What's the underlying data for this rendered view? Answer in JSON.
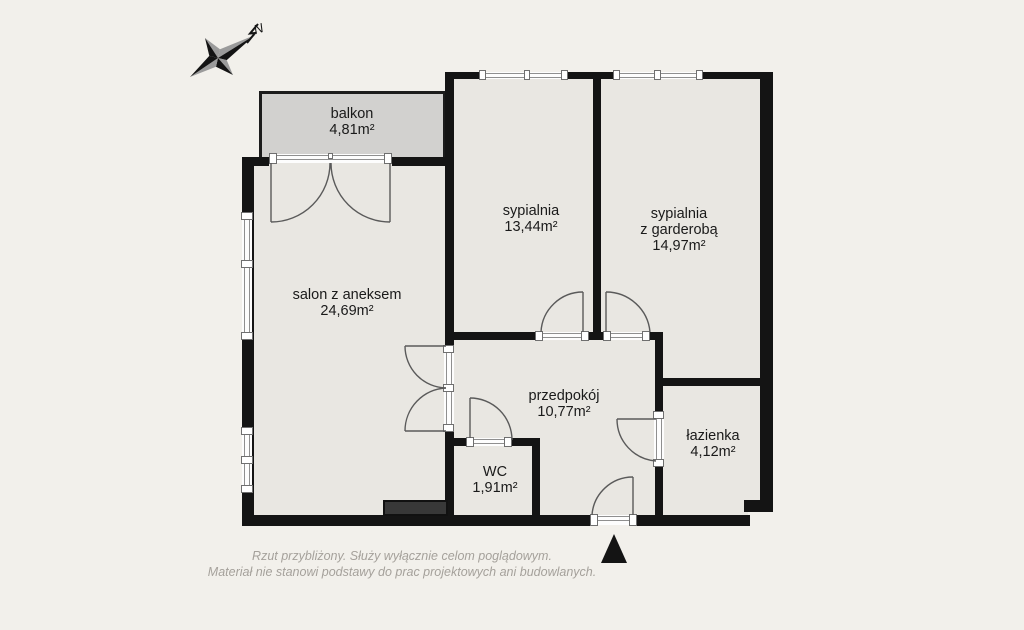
{
  "meta": {
    "background": "#f2f0eb",
    "room_fill": "#e9e7e2",
    "wall_color": "#141414",
    "balcony_fill": "#d2d1cf",
    "dark_block_color": "#383838",
    "door_line_color": "#5a5a5a",
    "label_color": "#1a1a1a",
    "footer_color": "#a5a19b"
  },
  "compass": {
    "north_label": "N"
  },
  "rooms": [
    {
      "id": "balkon",
      "name": "balkon",
      "area": "4,81m²"
    },
    {
      "id": "salon",
      "name": "salon z aneksem",
      "area": "24,69m²"
    },
    {
      "id": "sypialnia",
      "name": "sypialnia",
      "area": "13,44m²"
    },
    {
      "id": "sypialnia-z-garderoba",
      "name": "sypialnia",
      "name2": "z garderobą",
      "area": "14,97m²"
    },
    {
      "id": "przedpokoj",
      "name": "przedpokój",
      "area": "10,77m²"
    },
    {
      "id": "wc",
      "name": "WC",
      "area": "1,91m²"
    },
    {
      "id": "lazienka",
      "name": "łazienka",
      "area": "4,12m²"
    }
  ],
  "footer": {
    "line1": "Rzut przybliżony. Służy wyłącznie celom poglądowym.",
    "line2": "Materiał nie stanowi podstawy do prac projektowych ani budowlanych."
  }
}
